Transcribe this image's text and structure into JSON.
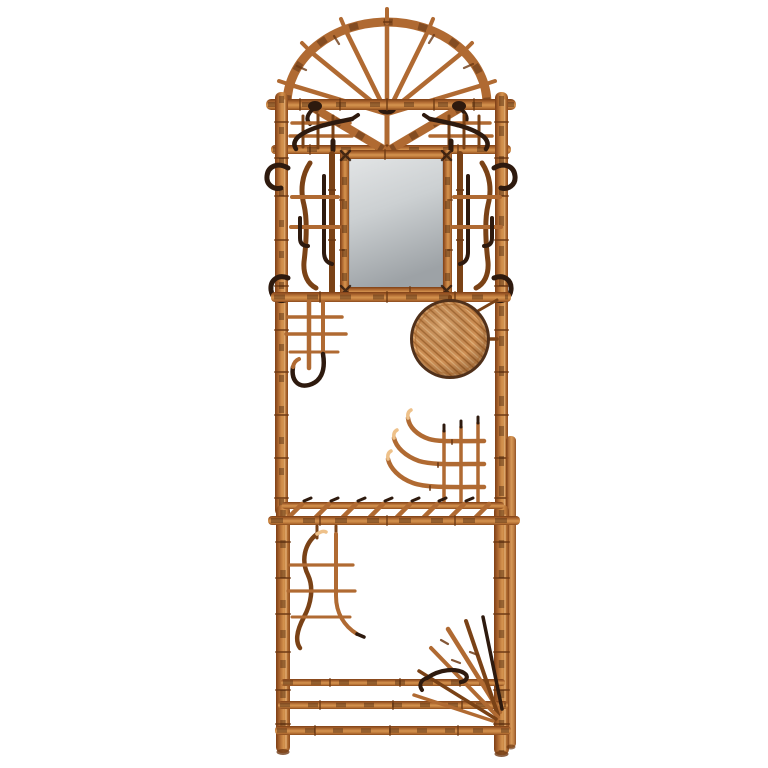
{
  "scene": {
    "domain": "natural-image",
    "subject": "Antique tortoise-shell bamboo hall stand with arched fan crest, mirror, rattan medallion and umbrella-stand base, photographed on a white background",
    "background_color": "#ffffff",
    "object_count": 1
  },
  "palette": {
    "background": "#ffffff",
    "bamboo_base": "#b06a32",
    "bamboo_light": "#d99a5d",
    "bamboo_highlight": "#eec18a",
    "bamboo_dark": "#7a4216",
    "bamboo_burn": "#46230c",
    "node": "#6d3a14",
    "hook_metal": "#2e1a0e",
    "mirror_light": "#e3e5e6",
    "mirror_mid": "#ccd0d2",
    "mirror_dark": "#9da2a6",
    "wicker_base": "#cf9055",
    "wicker_light": "#e2b27c",
    "wicker_shadow": "#a5672f",
    "wicker_rim": "#50301a"
  },
  "parts": {
    "crest": "arched bamboo fan with seven spokes and finial pegs",
    "top_rails": "double bamboo cross rails",
    "v_braces": "diagonal bamboo V braces with dark lashings",
    "top_side_motifs": "small lattice sprays with iron swoosh hooks",
    "posts": "two knotted bamboo uprights",
    "garment_hooks": "four curled iron coat hooks",
    "mirror": "rectangular mirror in bamboo frame",
    "side_lattice_panels": "asymmetric bamboo stick panels flanking the mirror",
    "mid_rail": "bamboo rail below mirror",
    "mid_lattice": "open lattice ornament with curved drop hook",
    "rattan_disc": "woven rattan medallion",
    "swan_rack": "three upswept bamboo rack arms over grid",
    "shelf": "glove shelf with slanted bamboo rungs",
    "legs": "bamboo legs with rear right leg",
    "lower_lattice": "S-curved bamboo ornament under shelf",
    "base_rails": "three-bar umbrella stand base",
    "stick_fan": "radiating bamboo stick fan at lower right"
  }
}
